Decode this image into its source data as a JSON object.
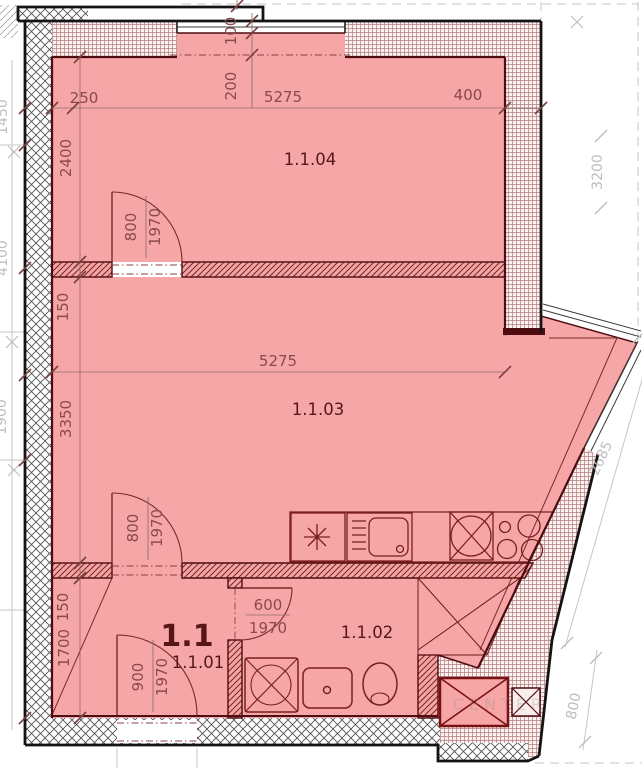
{
  "plan": {
    "unit_label": "1.1",
    "rooms": [
      {
        "id": "1.1.04",
        "label": "1.1.04"
      },
      {
        "id": "1.1.03",
        "label": "1.1.03"
      },
      {
        "id": "1.1.02",
        "label": "1.1.02"
      },
      {
        "id": "1.1.01",
        "label": "1.1.01"
      }
    ],
    "dims": {
      "top_250": "250",
      "top_5275": "5275",
      "top_400": "400",
      "top_200": "200",
      "top_100": "100",
      "left_2400": "2400",
      "left_150_upper": "150",
      "left_3350": "3350",
      "left_150_lower": "150",
      "left_1700": "1700",
      "mid_5275": "5275",
      "door_bedroom_w": "800",
      "door_bedroom_h": "1970",
      "door_living_w": "800",
      "door_living_h": "1970",
      "door_bath_w": "600",
      "door_bath_h": "1970",
      "door_entry_w": "900",
      "door_entry_h": "1970",
      "out_right_3200": "3200",
      "out_diag_2685": "2685",
      "out_br_800": "800",
      "out_left_a": "1450",
      "out_left_b": "4100",
      "out_left_c": "1900"
    },
    "watermark": "CENTER",
    "colors": {
      "room_fill": "#f6a6a6",
      "wall_line": "#4d0d10",
      "dim_text": "#8a4a4a",
      "outline": "#141414",
      "gray": "#bdbdbd"
    }
  }
}
